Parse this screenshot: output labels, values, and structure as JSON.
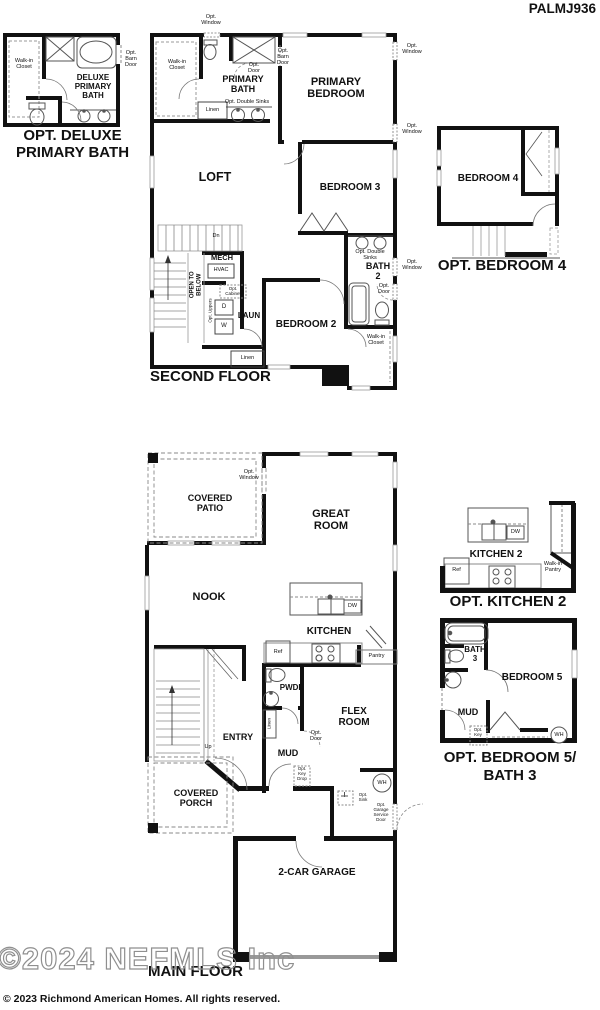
{
  "plan_id": "PALMJ936",
  "colors": {
    "wall": "#111111",
    "fixture_line": "#555555",
    "dashed_line": "#888888",
    "watermark_outline": "#8f8f8f",
    "garage_door": "#999999"
  },
  "deluxe_bath_inset": {
    "caption": "OPT. DELUXE\nPRIMARY BATH",
    "walk_in_closet": "Walk-in\nCloset",
    "room": "DELUXE\nPRIMARY\nBATH",
    "opt_barn_door": "Opt.\nBarn\nDoor"
  },
  "second_floor": {
    "caption": "SECOND FLOOR",
    "opt_window_top": "Opt.\nWindow",
    "walk_in_closet": "Walk-in\nCloset",
    "primary_bath": "PRIMARY\nBATH",
    "opt_door": "Opt.\nDoor",
    "opt_barn_door": "Opt.\nBarn\nDoor",
    "opt_double_sinks": "Opt. Double Sinks",
    "linen_1": "Linen",
    "primary_bedroom": "PRIMARY\nBEDROOM",
    "opt_window_right_1": "Opt.\nWindow",
    "loft": "LOFT",
    "bedroom3": "BEDROOM 3",
    "opt_window_right_2": "Opt.\nWindow",
    "opt_double_sinks_2": "Opt. Double\nSinks",
    "bath2": "BATH\n2",
    "opt_window_right_3": "Opt.\nWindow",
    "opt_door_2": "Opt.\nDoor",
    "bedroom2": "BEDROOM 2",
    "walk_in_closet_2": "Walk-in\nCloset",
    "mech": "MECH",
    "hvac": "HVAC",
    "opt_cabinet": "Opt.\nCabinet",
    "opt_uppers": "Opt. Uppers",
    "dryer": "D",
    "washer": "W",
    "laun": "LAUN",
    "open_to_below": "OPEN TO\nBELOW",
    "dn": "Dn",
    "linen_2": "Linen"
  },
  "bedroom4_inset": {
    "caption": "OPT. BEDROOM 4",
    "bedroom4": "BEDROOM 4"
  },
  "main_floor": {
    "caption": "MAIN FLOOR",
    "covered_patio": "COVERED\nPATIO",
    "opt_window": "Opt.\nWindow",
    "great_room": "GREAT\nROOM",
    "nook": "NOOK",
    "kitchen": "KITCHEN",
    "dw": "DW",
    "ref": "Ref",
    "pantry": "Pantry",
    "pwdr": "PWDR",
    "linen": "Linen",
    "entry": "ENTRY",
    "up": "Up",
    "mud": "MUD",
    "opt_door": "Opt.\nDoor",
    "flex_room": "FLEX\nROOM",
    "opt_key_drop": "Opt.\nKey\nDrop",
    "covered_porch": "COVERED\nPORCH",
    "wh": "WH",
    "opt_sink": "Opt.\nSink",
    "opt_garage_service_door": "Opt.\nGarage\nService\nDoor",
    "garage": "2-CAR GARAGE"
  },
  "kitchen2_inset": {
    "caption": "OPT. KITCHEN 2",
    "kitchen2": "KITCHEN 2",
    "dw": "DW",
    "ref": "Ref",
    "walk_in_pantry": "Walk-in\nPantry"
  },
  "bedroom5_inset": {
    "caption": "OPT. BEDROOM 5/\nBATH 3",
    "bath3": "BATH\n3",
    "bedroom5": "BEDROOM 5",
    "mud": "MUD",
    "opt_key_drop": "Opt.\nKey\nDrop",
    "wh": "WH"
  },
  "footer": {
    "watermark": "©2024 NEFMLS Inc",
    "copyright": "© 2023 Richmond American Homes. All rights reserved."
  }
}
